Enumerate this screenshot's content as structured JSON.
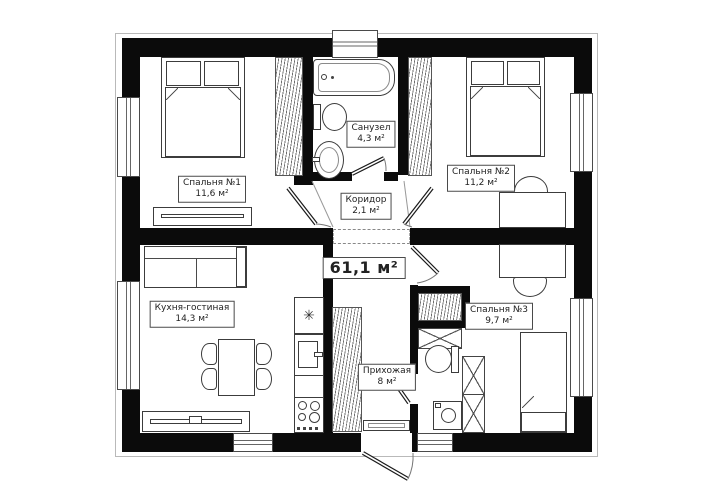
{
  "plan": {
    "total_area": "61,1 м²",
    "rooms": [
      {
        "id": "bedroom1",
        "name": "Спальня №1",
        "area": "11,6 м²"
      },
      {
        "id": "bathroom",
        "name": "Санузел",
        "area": "4,3 м²"
      },
      {
        "id": "bedroom2",
        "name": "Спальня №2",
        "area": "11,2 м²"
      },
      {
        "id": "corridor",
        "name": "Коридор",
        "area": "2,1 м²"
      },
      {
        "id": "kitchen_living",
        "name": "Кухня-гостиная",
        "area": "14,3 м²"
      },
      {
        "id": "hallway",
        "name": "Прихожая",
        "area": "8 м²"
      },
      {
        "id": "bedroom3",
        "name": "Спальня №3",
        "area": "9,7 м²"
      }
    ],
    "icons": {
      "fridge": "✳"
    },
    "colors": {
      "wall": "#0b0b0b",
      "furniture_line": "#3c3c3c",
      "label_border": "#4a4a4a",
      "background": "#ffffff"
    }
  }
}
